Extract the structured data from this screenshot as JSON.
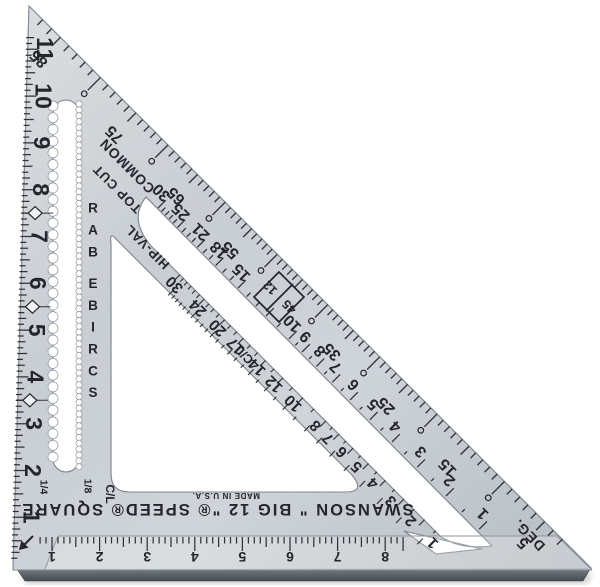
{
  "brand": {
    "line": "SWANSON \" BIG 12 \"® SPEED® SQUARE",
    "made_in": "MADE IN U.S.A."
  },
  "edge_ruler": {
    "numbers": [
      1,
      2,
      3,
      4,
      5,
      6,
      7,
      8,
      9,
      10,
      11
    ],
    "diamonds": [
      3.5,
      5.5,
      7.5
    ]
  },
  "lip_ruler": {
    "numbers": [
      1,
      2,
      3,
      4,
      5,
      6,
      7,
      8
    ]
  },
  "degree_scale": {
    "label": "DEG.",
    "numbers": [
      5,
      15,
      25,
      35,
      55,
      65,
      75,
      85
    ],
    "diamond_pitch": "12",
    "diamond_degrees": "45"
  },
  "common_scale": {
    "label": "COMMON",
    "numbers": [
      30,
      25,
      21,
      18,
      15,
      10,
      9,
      8,
      7,
      6,
      5,
      4,
      3,
      2,
      1
    ]
  },
  "hip_val_scale": {
    "label": "HIP-VAL",
    "numbers": [
      30,
      24,
      20,
      17,
      14,
      12,
      10,
      8,
      7,
      6,
      5,
      4,
      3,
      2,
      1
    ],
    "centerline": "C/L"
  },
  "top_cut_label": "TOP CUT",
  "scribe": {
    "label": "SCRIBE BAR",
    "quarter": "1/4",
    "eighth": "1/8",
    "centerline": "C/L"
  },
  "colors": {
    "metal_light": "#dadee1",
    "metal_mid": "#c6ccd1",
    "metal_mid2": "#cdd3d7",
    "metal_dark": "#b2b9bf",
    "ink": "#23262b",
    "edge": "#767e86",
    "lip_side_top": "#757b82",
    "lip_side_bottom": "#45494e",
    "diamond_fill": "#eef0f2"
  }
}
